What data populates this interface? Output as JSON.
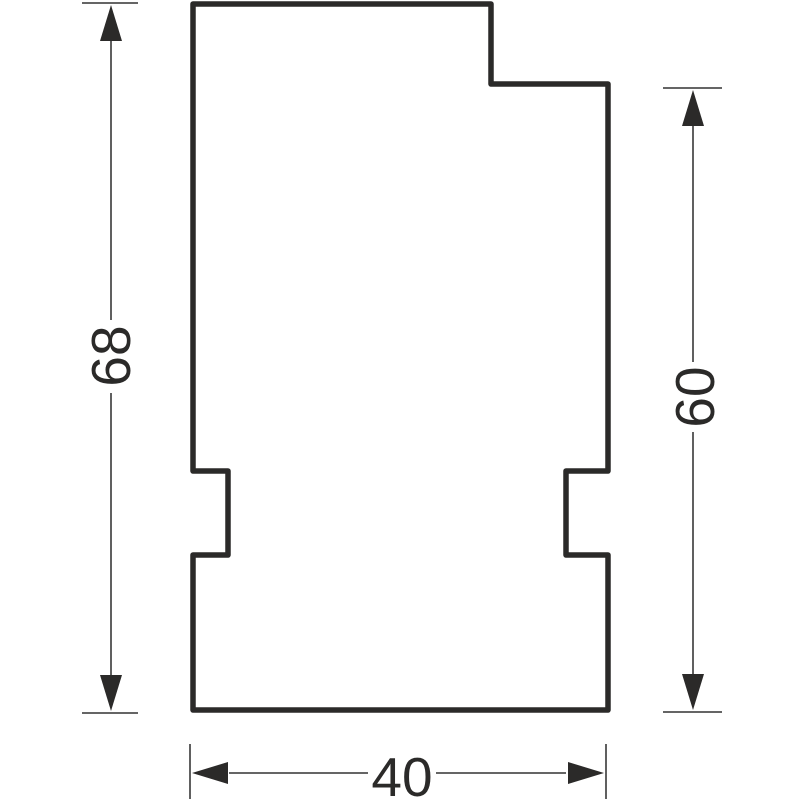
{
  "drawing": {
    "type": "technical-profile-drawing",
    "colors": {
      "background": "#ffffff",
      "outline": "#2b2a29",
      "dimension_line": "#4f4f4f",
      "arrow": "#2b2a29",
      "text": "#2b2a29"
    },
    "profile": {
      "name": "stepped-plate-profile",
      "description": "closed outline with top-right step and two side notches",
      "outline_points": [
        [
          193,
          4
        ],
        [
          491,
          4
        ],
        [
          491,
          84
        ],
        [
          608,
          84
        ],
        [
          608,
          471
        ],
        [
          566,
          471
        ],
        [
          566,
          555
        ],
        [
          608,
          555
        ],
        [
          608,
          710
        ],
        [
          193,
          710
        ],
        [
          193,
          555
        ],
        [
          228,
          555
        ],
        [
          228,
          471
        ],
        [
          193,
          471
        ]
      ],
      "stroke_width": 5.5
    },
    "dimensions": [
      {
        "name": "overall-height-dimension",
        "label": "68",
        "text_rotation": -90,
        "text_center": [
          110,
          356
        ],
        "thin_lines": [
          [
            82,
            3,
            138,
            3
          ],
          [
            82,
            713,
            138,
            713
          ],
          [
            111,
            41,
            111,
            320
          ],
          [
            111,
            393,
            111,
            675
          ]
        ],
        "arrows": [
          {
            "tip": [
              111,
              5
            ],
            "dir": "up"
          },
          {
            "tip": [
              111,
              711
            ],
            "dir": "down"
          }
        ]
      },
      {
        "name": "right-height-dimension",
        "label": "60",
        "text_rotation": -90,
        "text_center": [
          694,
          397
        ],
        "thin_lines": [
          [
            663,
            88,
            722,
            88
          ],
          [
            663,
            712,
            722,
            712
          ],
          [
            693,
            126,
            693,
            362
          ],
          [
            693,
            432,
            693,
            674
          ]
        ],
        "arrows": [
          {
            "tip": [
              693,
              90
            ],
            "dir": "up"
          },
          {
            "tip": [
              693,
              710
            ],
            "dir": "down"
          }
        ]
      },
      {
        "name": "width-dimension",
        "label": "40",
        "text_rotation": 0,
        "text_center": [
          402,
          776
        ],
        "thin_lines": [
          [
            190,
            744,
            190,
            799
          ],
          [
            606,
            744,
            606,
            799
          ],
          [
            229,
            773,
            368,
            773
          ],
          [
            436,
            773,
            566,
            773
          ]
        ],
        "arrows": [
          {
            "tip": [
              192,
              773
            ],
            "dir": "left"
          },
          {
            "tip": [
              604,
              773
            ],
            "dir": "right"
          }
        ]
      }
    ],
    "arrow_length": 36,
    "arrow_half_width": 11,
    "font_size_px": 55
  }
}
